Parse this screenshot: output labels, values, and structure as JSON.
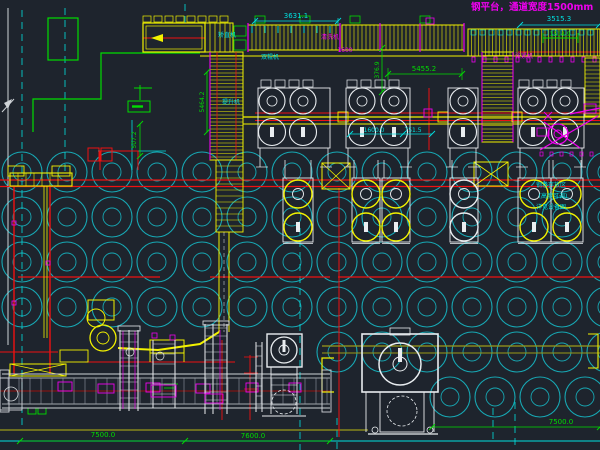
{
  "drawing": {
    "title": "钢平台，通道宽度1500mm"
  },
  "colors": {
    "background": "#1e242d",
    "yellow": "#f2f200",
    "olive": "#9a9a18",
    "cyan": "#00e0e0",
    "field_cyan": "#17a8b4",
    "red": "#ee1111",
    "dark_red": "#7e1414",
    "green": "#00dd00",
    "magenta": "#ee00ee",
    "white": "#e9edf0",
    "gray": "#9aa2ac"
  },
  "texts": [
    {
      "name": "drawing-title",
      "text": "钢平台，通道宽度1500mm",
      "x": 471,
      "y": 10,
      "color": "magenta",
      "size": 9.5,
      "anchor": "start",
      "bold": true
    },
    {
      "name": "dim-3631",
      "text": "3631.1",
      "x": 296,
      "y": 18,
      "color": "cyan",
      "size": 7
    },
    {
      "name": "dim-3515",
      "text": "3515.3",
      "x": 559,
      "y": 21,
      "color": "cyan",
      "size": 7
    },
    {
      "name": "dim-1514",
      "text": "1514.9",
      "x": 560,
      "y": 36,
      "color": "green",
      "size": 6
    },
    {
      "name": "dim-5455",
      "text": "5455.2",
      "x": 424,
      "y": 71,
      "color": "green",
      "size": 7
    },
    {
      "name": "dim-376",
      "text": "376.9",
      "x": 379,
      "y": 70,
      "color": "green",
      "size": 6,
      "rotate": -90
    },
    {
      "name": "dim-5464",
      "text": "5464.2",
      "x": 204,
      "y": 102,
      "color": "green",
      "size": 6,
      "rotate": -90
    },
    {
      "name": "dim-507",
      "text": "507.2",
      "x": 136,
      "y": 140,
      "color": "green",
      "size": 6,
      "rotate": -90
    },
    {
      "name": "dim-1600",
      "text": "1600.0",
      "x": 374,
      "y": 132,
      "color": "cyan",
      "size": 6
    },
    {
      "name": "dim-751",
      "text": "751.5",
      "x": 413,
      "y": 132,
      "color": "cyan",
      "size": 6
    },
    {
      "name": "label-1600",
      "text": "1600",
      "x": 345,
      "y": 52,
      "color": "magenta",
      "size": 6
    },
    {
      "name": "label-jiaozhiji",
      "text": "矫直机",
      "x": 227,
      "y": 37,
      "color": "cyan",
      "size": 6
    },
    {
      "name": "label-qingxiji",
      "text": "清洗机",
      "x": 330,
      "y": 39,
      "color": "magenta",
      "size": 6
    },
    {
      "name": "label-shuanggunji",
      "text": "双辊机",
      "x": 270,
      "y": 59,
      "color": "cyan",
      "size": 6
    },
    {
      "name": "label-zhangjinji",
      "text": "张紧机",
      "x": 524,
      "y": 58,
      "color": "magenta",
      "size": 6
    },
    {
      "name": "label-tishengji",
      "text": "提升机",
      "x": 231,
      "y": 104,
      "color": "cyan",
      "size": 6
    },
    {
      "name": "note-line-1",
      "text": "钢卷存放区",
      "x": 551,
      "y": 187,
      "color": "cyan",
      "size": 6
    },
    {
      "name": "note-line-2",
      "text": "(高度可调)",
      "x": 553,
      "y": 198,
      "color": "cyan",
      "size": 6
    },
    {
      "name": "note-line-3",
      "text": "详见设备图",
      "x": 551,
      "y": 209,
      "color": "cyan",
      "size": 6
    },
    {
      "name": "dim-7500-left",
      "text": "7500.0",
      "x": 103,
      "y": 437,
      "color": "green",
      "size": 7
    },
    {
      "name": "dim-7600-mid",
      "text": "7600.0",
      "x": 253,
      "y": 438,
      "color": "green",
      "size": 7
    },
    {
      "name": "dim-7500-right",
      "text": "7500.0",
      "x": 561,
      "y": 424,
      "color": "green",
      "size": 7
    }
  ]
}
